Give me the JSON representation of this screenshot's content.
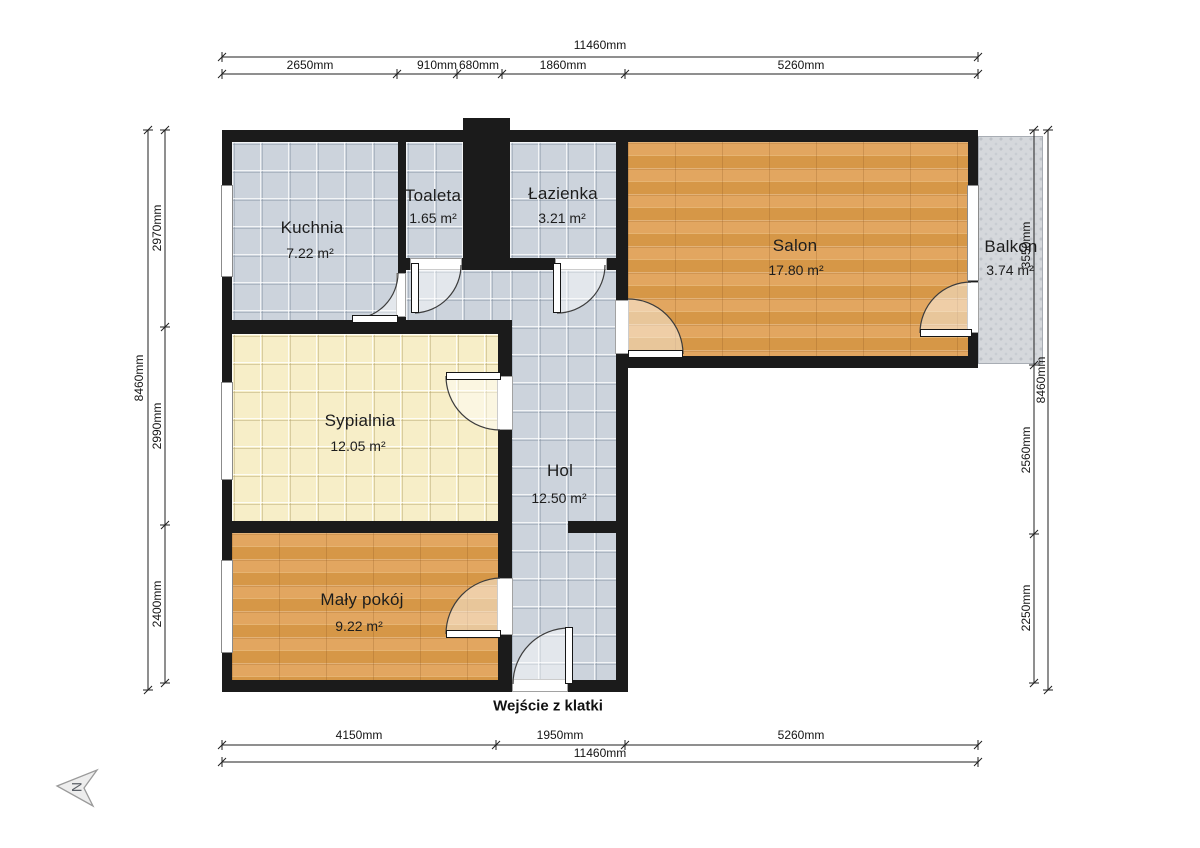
{
  "rooms": [
    {
      "name": "Kuchnia",
      "area": "7.22 m²"
    },
    {
      "name": "Toaleta",
      "area": "1.65 m²"
    },
    {
      "name": "Łazienka",
      "area": "3.21 m²"
    },
    {
      "name": "Salon",
      "area": "17.80 m²"
    },
    {
      "name": "Balkon",
      "area": "3.74 m²"
    },
    {
      "name": "Sypialnia",
      "area": "12.05 m²"
    },
    {
      "name": "Hol",
      "area": "12.50 m²"
    },
    {
      "name": "Mały pokój",
      "area": "9.22 m²"
    }
  ],
  "dimensions": {
    "top": {
      "total": "11460mm",
      "segments": [
        "2650mm",
        "910mm",
        "680mm",
        "1860mm",
        "5260mm"
      ]
    },
    "bottom": {
      "total": "11460mm",
      "segments": [
        "4150mm",
        "1950mm",
        "5260mm"
      ]
    },
    "left": {
      "total": "8460mm",
      "segments": [
        "2970mm",
        "2990mm",
        "2400mm"
      ]
    },
    "right": {
      "total": "8460mm",
      "segments": [
        "3550mm",
        "2560mm",
        "2250mm"
      ]
    }
  },
  "labels": {
    "entrance": "Wejście z klatki",
    "compass": "N"
  },
  "colors": {
    "wall": "#1b1b1b",
    "tile_floor": "#ccd3dc",
    "wood_floor": "#dea158",
    "bedroom_floor": "#f7eec8",
    "balcony_floor": "#d5d8dc"
  }
}
